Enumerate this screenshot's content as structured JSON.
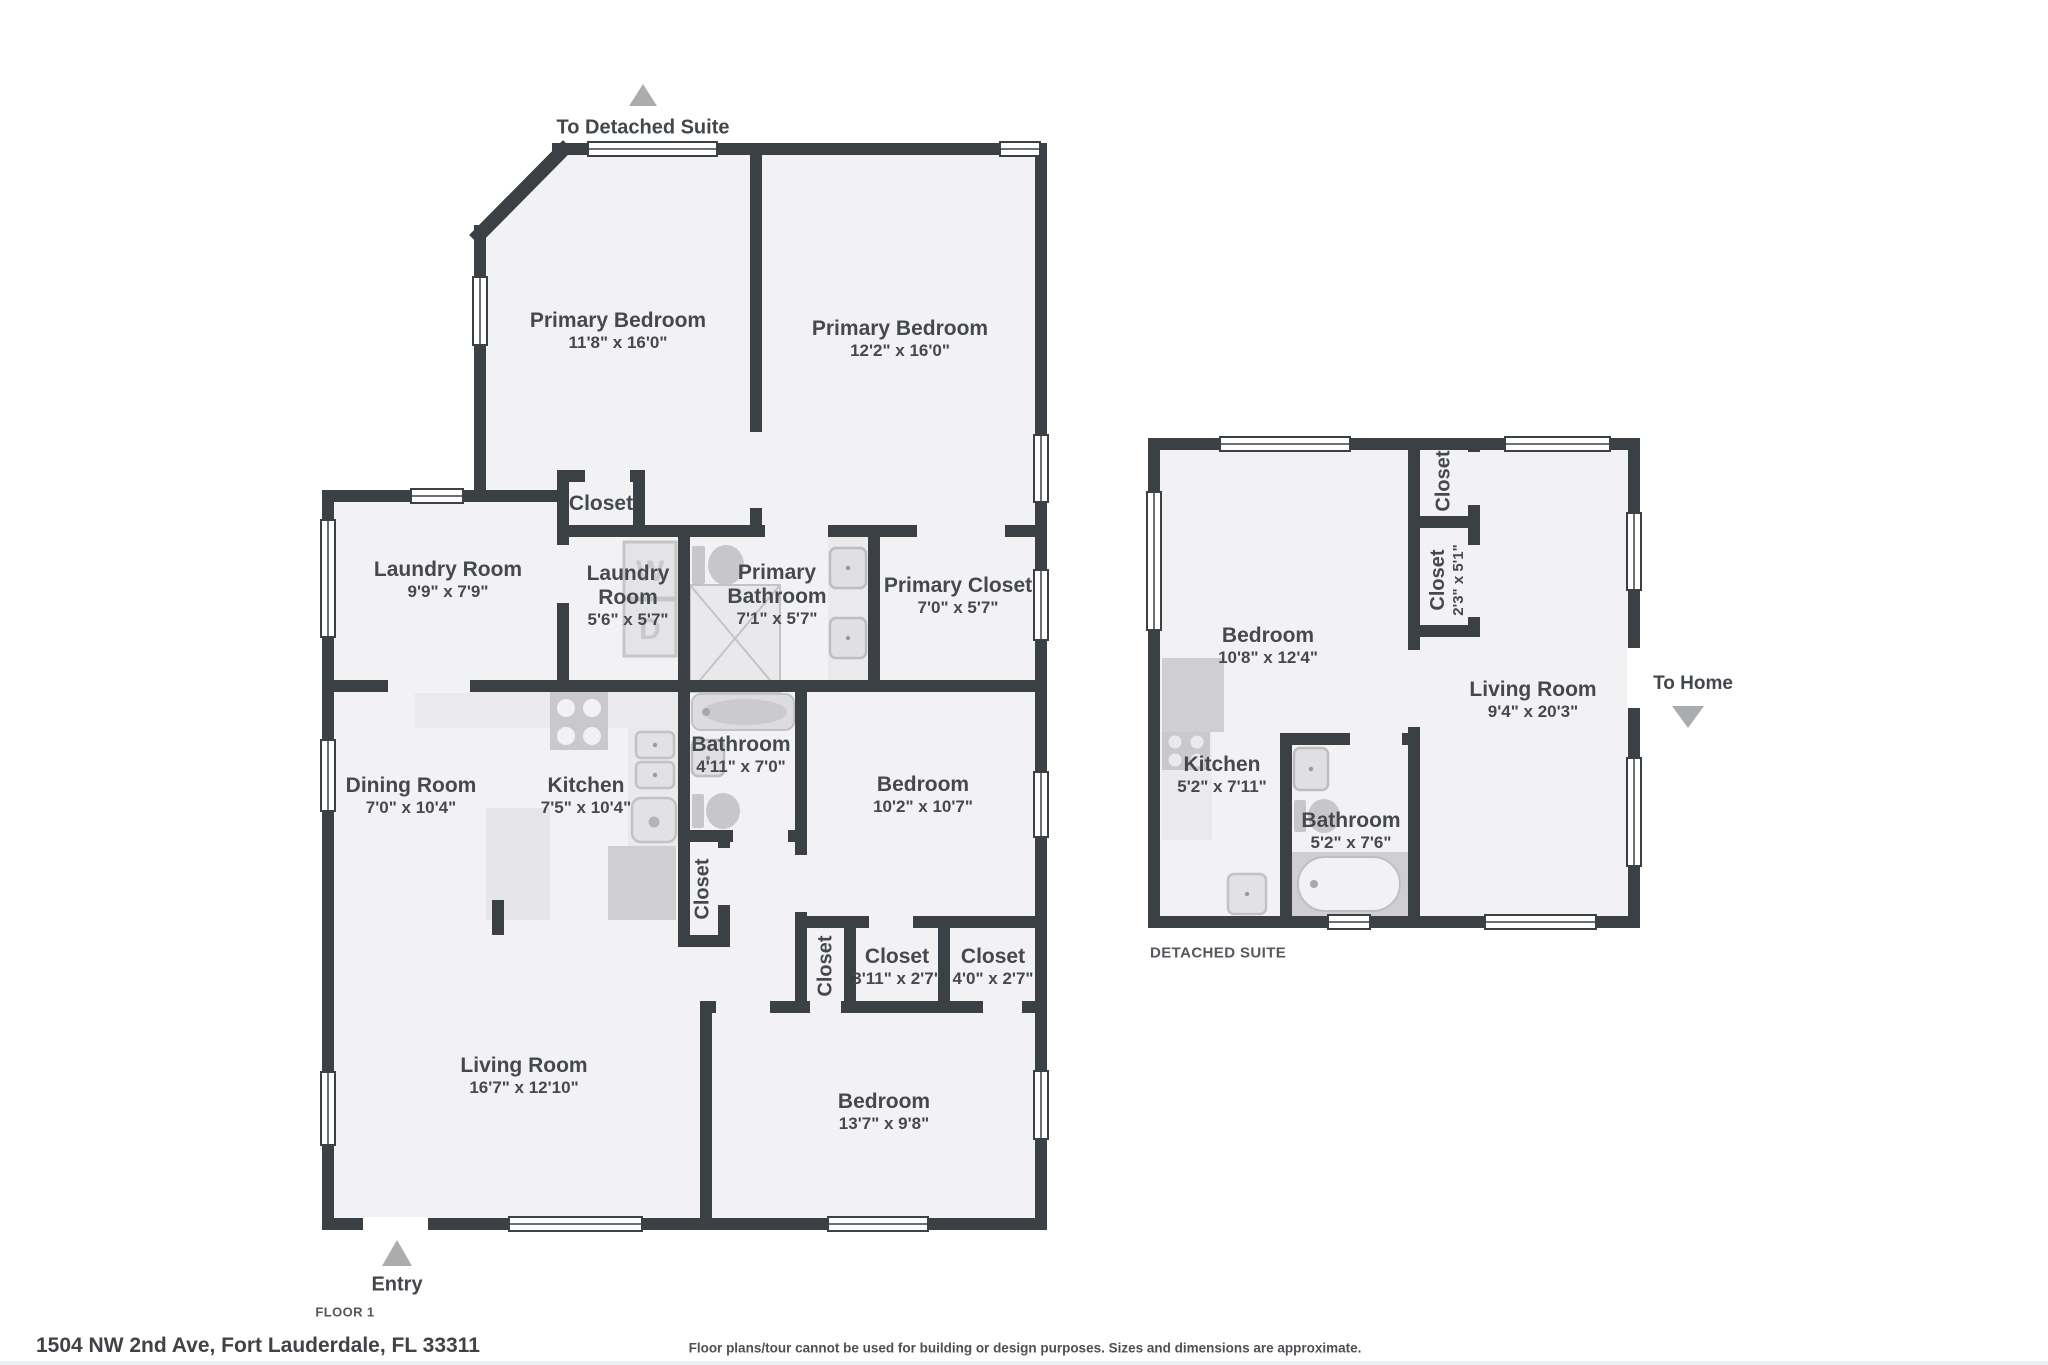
{
  "page": {
    "address": "1504 NW 2nd Ave, Fort Lauderdale, FL 33311",
    "disclaimer": "Floor plans/tour cannot be used for building or design purposes. Sizes and dimensions are approximate."
  },
  "colors": {
    "wall": "#3b4044",
    "floor": "#f2f2f4",
    "fixture_gray": "#c9c9cb",
    "counter_gray": "#eaeaec",
    "arrow_gray": "#abacae",
    "text": "#45494e"
  },
  "floor1": {
    "caption": "FLOOR 1",
    "entry_label": "Entry",
    "to_detached_suite_label": "To Detached Suite",
    "appliances": {
      "washer": "W",
      "dryer": "D"
    },
    "rooms": {
      "primary_bedroom_left": {
        "name": "Primary Bedroom",
        "dims": "11'8\" x 16'0\""
      },
      "primary_bedroom_right": {
        "name": "Primary Bedroom",
        "dims": "12'2\" x 16'0\""
      },
      "closet_top": {
        "name": "Closet"
      },
      "laundry_room_large": {
        "name": "Laundry Room",
        "dims": "9'9\" x 7'9\""
      },
      "laundry_room_small": {
        "name": "Laundry Room",
        "dims": "5'6\" x 5'7\""
      },
      "primary_bathroom": {
        "name": "Primary Bathroom",
        "dims": "7'1\" x 5'7\""
      },
      "primary_closet": {
        "name": "Primary Closet",
        "dims": "7'0\" x 5'7\""
      },
      "dining_room": {
        "name": "Dining Room",
        "dims": "7'0\" x 10'4\""
      },
      "kitchen": {
        "name": "Kitchen",
        "dims": "7'5\" x 10'4\""
      },
      "bathroom": {
        "name": "Bathroom",
        "dims": "4'11\" x 7'0\""
      },
      "bedroom_middle": {
        "name": "Bedroom",
        "dims": "10'2\" x 10'7\""
      },
      "closet_hall": {
        "name": "Closet"
      },
      "closet_small": {
        "name": "Closet"
      },
      "closet_311": {
        "name": "Closet",
        "dims": "3'11\" x 2'7\""
      },
      "closet_40": {
        "name": "Closet",
        "dims": "4'0\" x 2'7\""
      },
      "living_room": {
        "name": "Living Room",
        "dims": "16'7\" x 12'10\""
      },
      "bedroom_bottom": {
        "name": "Bedroom",
        "dims": "13'7\" x 9'8\""
      }
    }
  },
  "suite": {
    "caption": "DETACHED SUITE",
    "to_home_label": "To Home",
    "rooms": {
      "bedroom": {
        "name": "Bedroom",
        "dims": "10'8\" x 12'4\""
      },
      "closet_top": {
        "name": "Closet"
      },
      "closet_mid": {
        "name": "Closet",
        "dims": "2'3\" x 5'1\""
      },
      "living_room": {
        "name": "Living Room",
        "dims": "9'4\" x 20'3\""
      },
      "kitchen": {
        "name": "Kitchen",
        "dims": "5'2\" x 7'11\""
      },
      "bathroom": {
        "name": "Bathroom",
        "dims": "5'2\" x 7'6\""
      }
    }
  }
}
